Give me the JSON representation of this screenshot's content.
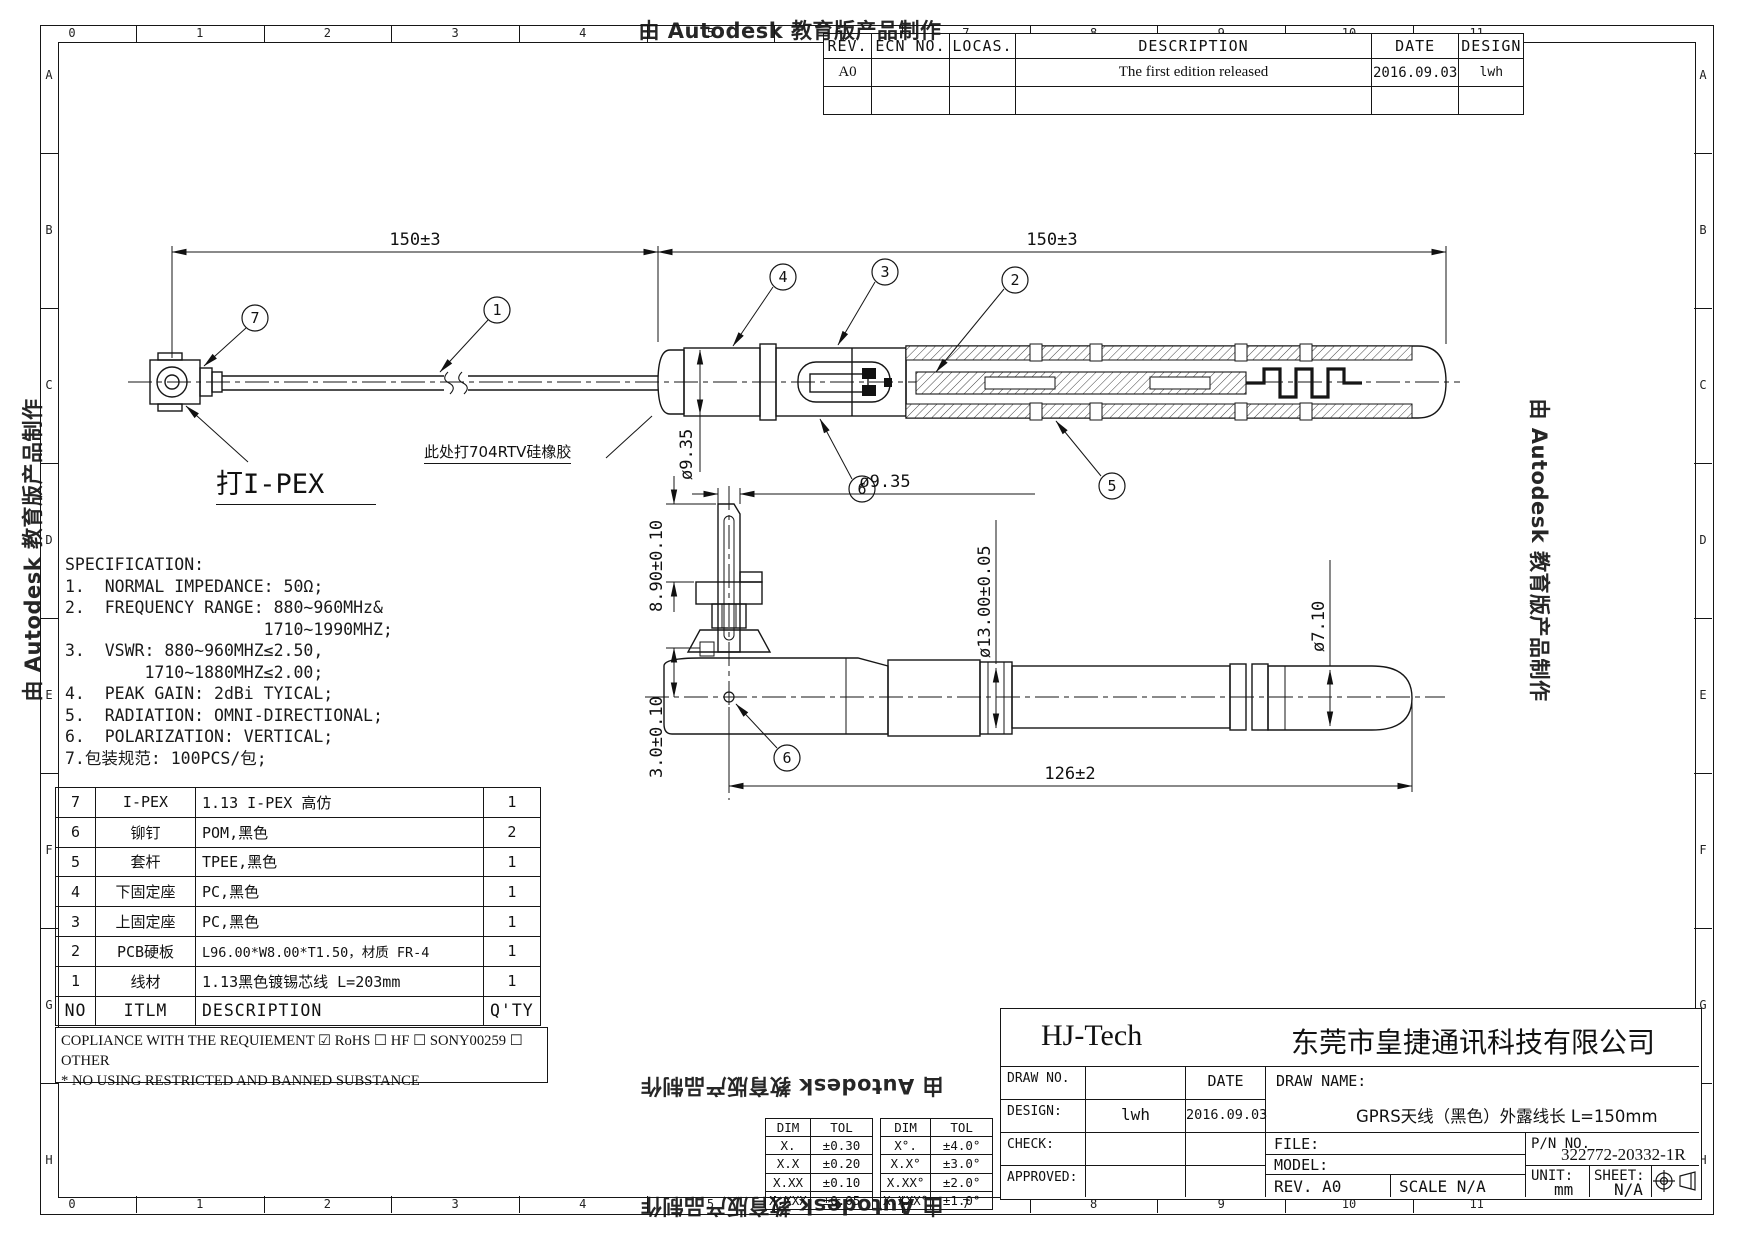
{
  "watermark": {
    "text": "由 Autodesk 教育版产品制作"
  },
  "grid": {
    "columns": [
      "0",
      "1",
      "2",
      "3",
      "4",
      "5",
      "6",
      "7",
      "8",
      "9",
      "10",
      "11"
    ],
    "rows": [
      "A",
      "B",
      "C",
      "D",
      "E",
      "F",
      "G",
      "H"
    ]
  },
  "revision": {
    "headers": [
      "REV.",
      "ECN NO.",
      "LOCAS.",
      "DESCRIPTION",
      "DATE",
      "DESIGN"
    ],
    "rows": [
      [
        "A0",
        "",
        "",
        "The first edition released",
        "2016.09.03",
        "lwh"
      ],
      [
        "",
        "",
        "",
        "",
        "",
        ""
      ]
    ]
  },
  "spec": {
    "lines": [
      "SPECIFICATION:",
      "1.  NORMAL IMPEDANCE: 50Ω;",
      "2.  FREQUENCY RANGE: 880~960MHz&",
      "                    1710~1990MHZ;",
      "3.  VSWR: 880~960MHZ≤2.50,",
      "        1710~1880MHZ≤2.00;",
      "4.  PEAK GAIN: 2dBi TYICAL;",
      "5.  RADIATION: OMNI-DIRECTIONAL;",
      "6.  POLARIZATION: VERTICAL;",
      "7.包装规范: 100PCS/包;"
    ]
  },
  "top_view": {
    "dim_cable": "150±3",
    "dim_body": "150±3",
    "dia": "ø9.35",
    "note": "此处打704RTV硅橡胶",
    "connector_label": "打I-PEX",
    "balloons": {
      "b7": "7",
      "b1": "1",
      "b4": "4",
      "b3": "3",
      "b2": "2",
      "b6": "6",
      "b5": "5"
    }
  },
  "bottom_view": {
    "dia_top": "ø9.35",
    "height": "8.90±0.10",
    "offset": "3.0±0.10",
    "dia_body": "ø13.00±0.05",
    "dia_tip": "ø7.10",
    "length": "126±2",
    "balloon": "6"
  },
  "bom": {
    "headers": [
      "NO",
      "ITLM",
      "DESCRIPTION",
      "Q'TY"
    ],
    "rows": [
      [
        "7",
        "I-PEX",
        "1.13 I-PEX 高仿",
        "1"
      ],
      [
        "6",
        "铆钉",
        "POM,黑色",
        "2"
      ],
      [
        "5",
        "套杆",
        "TPEE,黑色",
        "1"
      ],
      [
        "4",
        "下固定座",
        "PC,黑色",
        "1"
      ],
      [
        "3",
        "上固定座",
        "PC,黑色",
        "1"
      ],
      [
        "2",
        "PCB硬板",
        "L96.00*W8.00*T1.50，材质 FR-4",
        "1"
      ],
      [
        "1",
        "线材",
        "1.13黑色镀锡芯线 L=203mm",
        "1"
      ]
    ],
    "compliance_line1": "COPLIANCE WITH THE REQUIEMENT ☑ RoHS ☐ HF ☐ SONY00259 ☐ OTHER",
    "compliance_line2": "* NO USING RESTRICTED AND BANNED SUBSTANCE"
  },
  "tolerance": {
    "headers": [
      "DIM",
      "TOL"
    ],
    "linear": [
      [
        "X.",
        "±0.30"
      ],
      [
        "X.X",
        "±0.20"
      ],
      [
        "X.XX",
        "±0.10"
      ],
      [
        "X.XXX",
        "±0.05"
      ]
    ],
    "angular": [
      [
        "X°.",
        "±4.0°"
      ],
      [
        "X.X°",
        "±3.0°"
      ],
      [
        "X.XX°",
        "±2.0°"
      ],
      [
        "X.XXX°",
        "±1.0°"
      ]
    ]
  },
  "title_block": {
    "company_short": "HJ-Tech",
    "company_full": "东莞市皇捷通讯科技有限公司",
    "draw_no_label": "DRAW NO.",
    "date_label": "DATE",
    "design_label": "DESIGN:",
    "design_value": "lwh",
    "date_value": "2016.09.03",
    "check_label": "CHECK:",
    "approved_label": "APPROVED:",
    "draw_name_label": "DRAW NAME:",
    "draw_name_value": "GPRS天线（黑色）外露线长 L=150mm",
    "file_label": "FILE:",
    "model_label": "MODEL:",
    "rev_label": "REV. A0",
    "scale_label": "SCALE N/A",
    "pn_label": "P/N NO.",
    "pn_value": "322772-20332-1R",
    "unit_label": "UNIT:",
    "unit_value": "mm",
    "sheet_label": "SHEET:",
    "sheet_value": "N/A"
  }
}
